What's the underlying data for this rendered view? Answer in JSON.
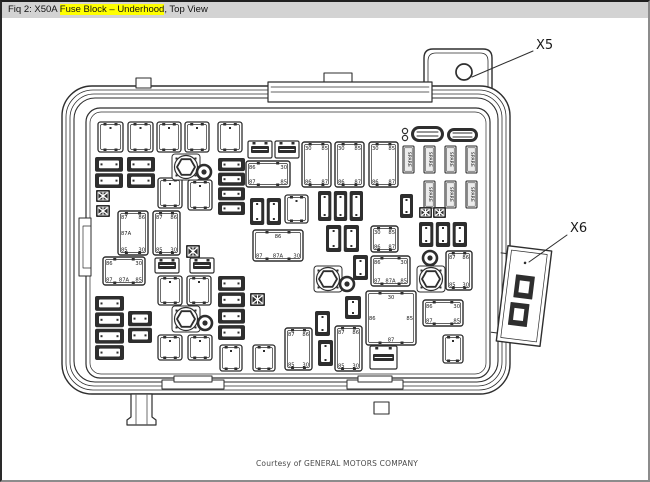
{
  "title_bar": {
    "prefix": "Fiq 2: X50A ",
    "highlight": "Fuse Block – Underhood",
    "suffix": ", Top View",
    "bg_color": "#d3d3d3",
    "highlight_color": "#ffff00"
  },
  "callouts": {
    "x5": {
      "label": "X5"
    },
    "x6": {
      "label": "X6"
    }
  },
  "footer": {
    "credit": "Courtesy of GENERAL MOTORS COMPANY"
  },
  "diagram": {
    "line_color": "#2e2e2e",
    "components": [
      {
        "t": "fuse",
        "x": 98,
        "y": 122,
        "w": 25,
        "h": 30
      },
      {
        "t": "fuse",
        "x": 128,
        "y": 122,
        "w": 25,
        "h": 30
      },
      {
        "t": "fuse",
        "x": 157,
        "y": 122,
        "w": 24,
        "h": 30
      },
      {
        "t": "fuse",
        "x": 185,
        "y": 122,
        "w": 24,
        "h": 30
      },
      {
        "t": "fuse",
        "x": 218,
        "y": 122,
        "w": 24,
        "h": 30
      },
      {
        "t": "fuse",
        "x": 158,
        "y": 178,
        "w": 24,
        "h": 30
      },
      {
        "t": "fuse",
        "x": 188,
        "y": 180,
        "w": 24,
        "h": 30
      },
      {
        "t": "fuse",
        "x": 285,
        "y": 195,
        "w": 23,
        "h": 28
      },
      {
        "t": "fuse",
        "x": 158,
        "y": 276,
        "w": 24,
        "h": 29
      },
      {
        "t": "fuse",
        "x": 187,
        "y": 276,
        "w": 24,
        "h": 29
      },
      {
        "t": "fuse",
        "x": 158,
        "y": 335,
        "w": 24,
        "h": 25
      },
      {
        "t": "fuse",
        "x": 188,
        "y": 335,
        "w": 24,
        "h": 25
      },
      {
        "t": "fuse",
        "x": 220,
        "y": 345,
        "w": 22,
        "h": 26
      },
      {
        "t": "fuse",
        "x": 253,
        "y": 345,
        "w": 22,
        "h": 26
      },
      {
        "t": "fuse",
        "x": 443,
        "y": 335,
        "w": 20,
        "h": 28
      },
      {
        "t": "relay",
        "x": 302,
        "y": 142,
        "w": 29,
        "h": 45,
        "l": {
          "tl": "30",
          "tr": "85",
          "bl": "86",
          "br": "87"
        }
      },
      {
        "t": "relay",
        "x": 335,
        "y": 142,
        "w": 29,
        "h": 45,
        "l": {
          "tl": "30",
          "tr": "85",
          "bl": "86",
          "br": "87"
        }
      },
      {
        "t": "relay",
        "x": 369,
        "y": 142,
        "w": 29,
        "h": 45,
        "l": {
          "tl": "30",
          "tr": "85",
          "bl": "86",
          "br": "87"
        }
      },
      {
        "t": "relay",
        "x": 246,
        "y": 161,
        "w": 44,
        "h": 26,
        "l": {
          "tl": "86",
          "tr": "30",
          "bl": "87",
          "br": "85"
        }
      },
      {
        "t": "relay",
        "x": 118,
        "y": 211,
        "w": 30,
        "h": 44,
        "l": {
          "tl": "87",
          "tr": "86",
          "ml": "87A",
          "bl": "85",
          "br": "30"
        }
      },
      {
        "t": "relay",
        "x": 153,
        "y": 211,
        "w": 27,
        "h": 44,
        "l": {
          "tl": "87",
          "tr": "86",
          "bl": "85",
          "br": "30"
        }
      },
      {
        "t": "relay",
        "x": 103,
        "y": 257,
        "w": 42,
        "h": 28,
        "l": {
          "tl": "86",
          "tr": "30",
          "b3": [
            "87",
            "87A",
            "85"
          ]
        }
      },
      {
        "t": "relay",
        "x": 253,
        "y": 230,
        "w": 50,
        "h": 31,
        "l": {
          "tc": "86",
          "b3": [
            "87",
            "87A",
            "30"
          ]
        }
      },
      {
        "t": "relay",
        "x": 371,
        "y": 256,
        "w": 39,
        "h": 30,
        "l": {
          "tl": "86",
          "tr": "30",
          "b3": [
            "87",
            "87A",
            "85"
          ]
        }
      },
      {
        "t": "relay",
        "x": 285,
        "y": 328,
        "w": 27,
        "h": 42,
        "l": {
          "tl": "87",
          "tr": "86",
          "bl": "85",
          "br": "30"
        }
      },
      {
        "t": "relay",
        "x": 335,
        "y": 326,
        "w": 27,
        "h": 45,
        "l": {
          "tl": "87",
          "tr": "86",
          "bl": "85",
          "br": "30"
        }
      },
      {
        "t": "relay",
        "x": 366,
        "y": 291,
        "w": 50,
        "h": 54,
        "l": {
          "tc": "30",
          "ml": "86",
          "mr": "85",
          "bc": "87"
        }
      },
      {
        "t": "relay",
        "x": 423,
        "y": 300,
        "w": 40,
        "h": 26,
        "l": {
          "tl": "86",
          "tr": "30",
          "bl": "87",
          "br": "85"
        }
      },
      {
        "t": "relay",
        "x": 446,
        "y": 251,
        "w": 26,
        "h": 39,
        "l": {
          "tl": "87",
          "tr": "86",
          "bl": "85",
          "br": "30"
        }
      },
      {
        "t": "relay",
        "x": 371,
        "y": 226,
        "w": 27,
        "h": 26,
        "l": {
          "tl": "30",
          "tr": "85",
          "bl": "86",
          "br": "87"
        }
      },
      {
        "t": "spare",
        "x": 403,
        "y": 146,
        "w": 11,
        "h": 27,
        "l": "SPARE"
      },
      {
        "t": "spare",
        "x": 424,
        "y": 146,
        "w": 11,
        "h": 27,
        "l": "SPARE"
      },
      {
        "t": "spare",
        "x": 445,
        "y": 146,
        "w": 11,
        "h": 27,
        "l": "SPARE"
      },
      {
        "t": "spare",
        "x": 466,
        "y": 146,
        "w": 11,
        "h": 27,
        "l": "SPARE"
      },
      {
        "t": "spare",
        "x": 424,
        "y": 181,
        "w": 11,
        "h": 27,
        "l": "SPARE"
      },
      {
        "t": "spare",
        "x": 445,
        "y": 181,
        "w": 11,
        "h": 27,
        "l": "SPARE"
      },
      {
        "t": "spare",
        "x": 466,
        "y": 181,
        "w": 11,
        "h": 27,
        "l": "SPARE"
      },
      {
        "t": "mstack",
        "n": 2,
        "x": 95,
        "y": 157,
        "w": 28,
        "h": 31
      },
      {
        "t": "mstack",
        "n": 2,
        "x": 127,
        "y": 157,
        "w": 28,
        "h": 31
      },
      {
        "t": "mstack",
        "n": 4,
        "x": 218,
        "y": 158,
        "w": 27,
        "h": 57
      },
      {
        "t": "mstack",
        "n": 4,
        "x": 218,
        "y": 276,
        "w": 27,
        "h": 64
      },
      {
        "t": "mstack",
        "n": 4,
        "x": 95,
        "y": 296,
        "w": 29,
        "h": 64
      },
      {
        "t": "mstack",
        "n": 2,
        "x": 128,
        "y": 311,
        "w": 24,
        "h": 32
      },
      {
        "t": "mrow",
        "n": 2,
        "x": 250,
        "y": 198,
        "w": 31,
        "h": 27
      },
      {
        "t": "mrow",
        "n": 3,
        "x": 318,
        "y": 191,
        "w": 45,
        "h": 30
      },
      {
        "t": "mrow",
        "n": 2,
        "x": 326,
        "y": 225,
        "w": 33,
        "h": 27
      },
      {
        "t": "mrow",
        "n": 3,
        "x": 419,
        "y": 222,
        "w": 48,
        "h": 25
      },
      {
        "t": "mrow",
        "n": 1,
        "x": 315,
        "y": 311,
        "w": 15,
        "h": 25
      },
      {
        "t": "mrow",
        "n": 1,
        "x": 318,
        "y": 340,
        "w": 15,
        "h": 26
      },
      {
        "t": "mrow",
        "n": 1,
        "x": 345,
        "y": 296,
        "w": 16,
        "h": 23
      },
      {
        "t": "mrow",
        "n": 1,
        "x": 353,
        "y": 255,
        "w": 15,
        "h": 25
      },
      {
        "t": "mrow",
        "n": 1,
        "x": 400,
        "y": 194,
        "w": 13,
        "h": 24
      },
      {
        "t": "xfuse",
        "x": 96,
        "y": 190,
        "w": 14,
        "h": 12
      },
      {
        "t": "xfuse",
        "x": 96,
        "y": 205,
        "w": 14,
        "h": 12
      },
      {
        "t": "xfuse",
        "x": 186,
        "y": 245,
        "w": 14,
        "h": 13
      },
      {
        "t": "xfuse",
        "x": 419,
        "y": 207,
        "w": 13,
        "h": 11
      },
      {
        "t": "xfuse",
        "x": 433,
        "y": 207,
        "w": 13,
        "h": 11
      },
      {
        "t": "xfuse",
        "x": 250,
        "y": 293,
        "w": 15,
        "h": 13
      },
      {
        "t": "slot",
        "x": 248,
        "y": 141,
        "w": 24,
        "h": 17
      },
      {
        "t": "slot",
        "x": 275,
        "y": 141,
        "w": 24,
        "h": 17
      },
      {
        "t": "slot",
        "x": 155,
        "y": 258,
        "w": 24,
        "h": 15
      },
      {
        "t": "slot",
        "x": 190,
        "y": 258,
        "w": 24,
        "h": 15
      },
      {
        "t": "slot",
        "x": 370,
        "y": 346,
        "w": 27,
        "h": 23
      },
      {
        "t": "hex",
        "x": 186,
        "y": 167
      },
      {
        "t": "hex",
        "x": 186,
        "y": 319
      },
      {
        "t": "hex",
        "x": 328,
        "y": 279
      },
      {
        "t": "hex",
        "x": 431,
        "y": 279
      },
      {
        "t": "target",
        "x": 204,
        "y": 172
      },
      {
        "t": "target",
        "x": 205,
        "y": 323
      },
      {
        "t": "target",
        "x": 347,
        "y": 284
      },
      {
        "t": "target",
        "x": 430,
        "y": 258
      },
      {
        "t": "puller",
        "x": 411,
        "y": 126,
        "w": 33,
        "h": 16,
        "pins": true
      },
      {
        "t": "puller",
        "x": 447,
        "y": 128,
        "w": 31,
        "h": 14
      }
    ]
  }
}
